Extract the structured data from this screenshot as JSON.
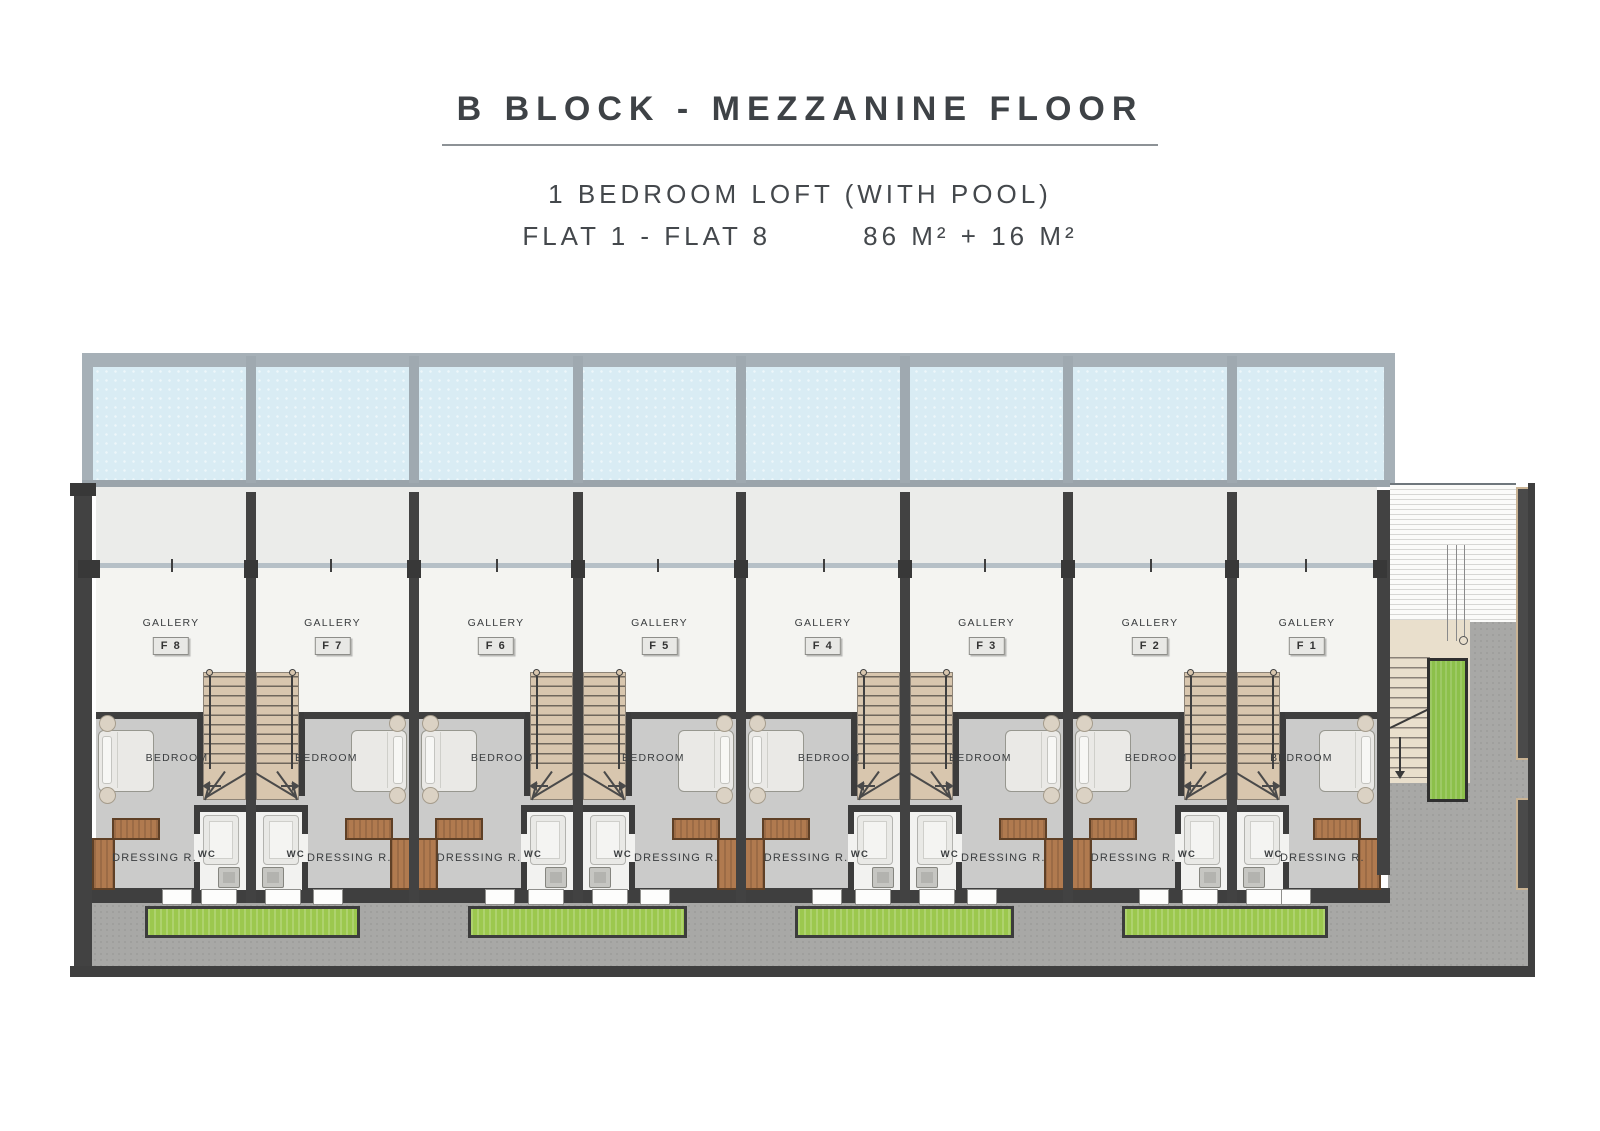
{
  "header": {
    "title": "B BLOCK  -  MEZZANINE FLOOR",
    "subtitle": "1 BEDROOM LOFT  (WITH POOL)",
    "flats_range": "FLAT 1 - FLAT 8",
    "area": "86 M² + 16 M²"
  },
  "room_labels": {
    "gallery": "GALLERY",
    "bedroom": "BEDROOM",
    "dressing": "DRESSING R.",
    "wc": "WC"
  },
  "units": [
    {
      "flat": "F 8"
    },
    {
      "flat": "F 7"
    },
    {
      "flat": "F 6"
    },
    {
      "flat": "F 5"
    },
    {
      "flat": "F 4"
    },
    {
      "flat": "F 3"
    },
    {
      "flat": "F 2"
    },
    {
      "flat": "F 1"
    }
  ],
  "colors": {
    "wall": "#424242",
    "water": "#d9ecf4",
    "wood": "#d8c6ae",
    "grass": "#9cc84e",
    "pavement": "#a8a8a6",
    "brown": "#b07a4f"
  }
}
